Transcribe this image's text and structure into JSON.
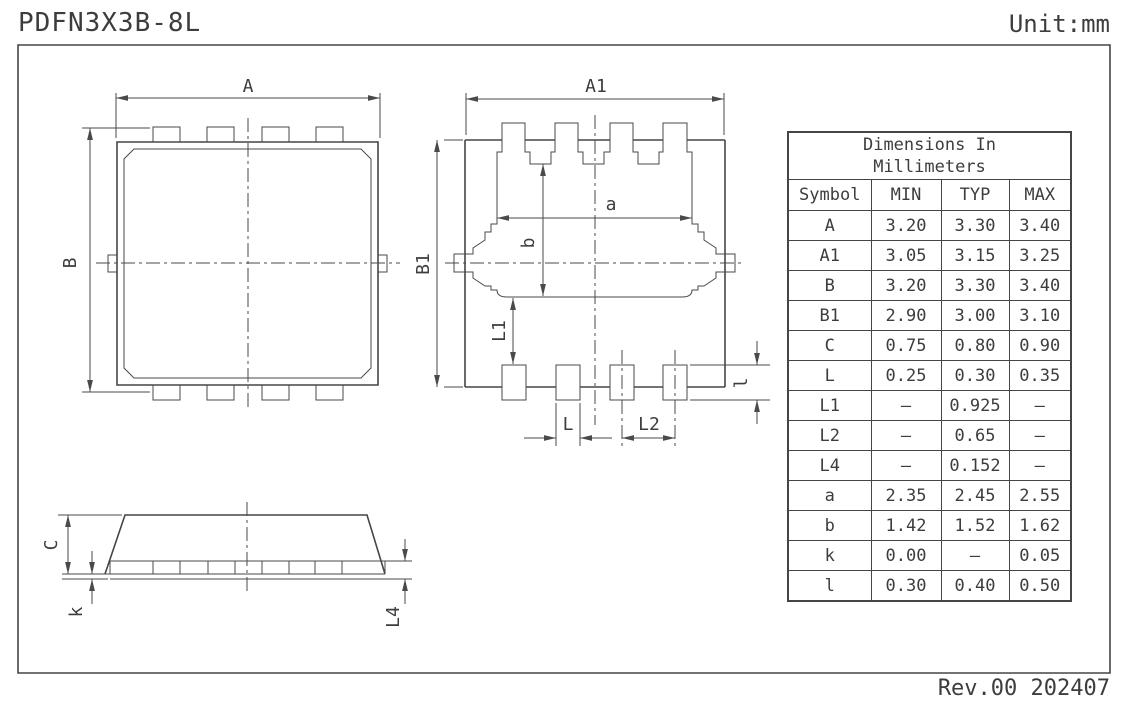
{
  "header": {
    "title": "PDFN3X3B-8L",
    "unit": "Unit:mm"
  },
  "footer": {
    "revision": "Rev.00 202407"
  },
  "views": {
    "top_view": {
      "labels": {
        "A": "A",
        "B": "B"
      }
    },
    "bottom_view": {
      "labels": {
        "A1": "A1",
        "B1": "B1",
        "a": "a",
        "b": "b",
        "L1": "L1",
        "L": "L",
        "L2": "L2",
        "l": "l"
      }
    },
    "side_view": {
      "labels": {
        "C": "C",
        "k": "k",
        "L4": "L4"
      }
    }
  },
  "table": {
    "title_line1": "Dimensions In",
    "title_line2": "Millimeters",
    "columns": [
      "Symbol",
      "MIN",
      "TYP",
      "MAX"
    ],
    "rows": [
      {
        "symbol": "A",
        "min": "3.20",
        "typ": "3.30",
        "max": "3.40"
      },
      {
        "symbol": "A1",
        "min": "3.05",
        "typ": "3.15",
        "max": "3.25"
      },
      {
        "symbol": "B",
        "min": "3.20",
        "typ": "3.30",
        "max": "3.40"
      },
      {
        "symbol": "B1",
        "min": "2.90",
        "typ": "3.00",
        "max": "3.10"
      },
      {
        "symbol": "C",
        "min": "0.75",
        "typ": "0.80",
        "max": "0.90"
      },
      {
        "symbol": "L",
        "min": "0.25",
        "typ": "0.30",
        "max": "0.35"
      },
      {
        "symbol": "L1",
        "min": "–",
        "typ": "0.925",
        "max": "–"
      },
      {
        "symbol": "L2",
        "min": "–",
        "typ": "0.65",
        "max": "–"
      },
      {
        "symbol": "L4",
        "min": "–",
        "typ": "0.152",
        "max": "–"
      },
      {
        "symbol": "a",
        "min": "2.35",
        "typ": "2.45",
        "max": "2.55"
      },
      {
        "symbol": "b",
        "min": "1.42",
        "typ": "1.52",
        "max": "1.62"
      },
      {
        "symbol": "k",
        "min": "0.00",
        "typ": "–",
        "max": "0.05"
      },
      {
        "symbol": "l",
        "min": "0.30",
        "typ": "0.40",
        "max": "0.50"
      }
    ]
  }
}
